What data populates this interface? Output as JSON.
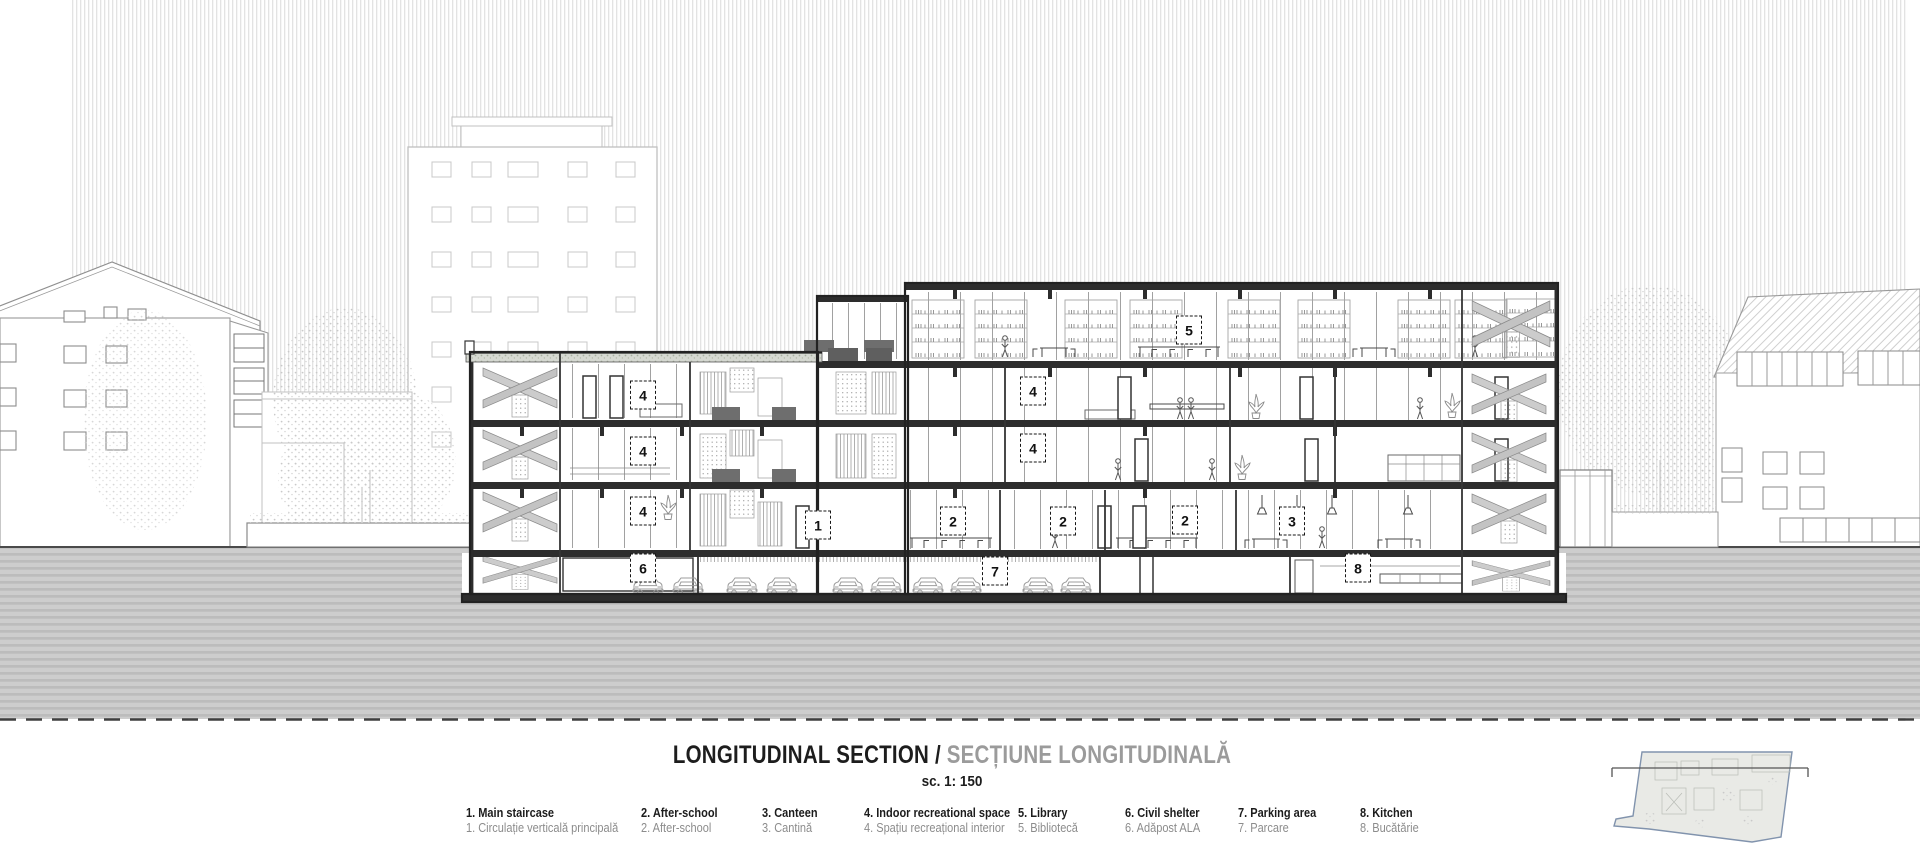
{
  "title": {
    "en": "LONGITUDINAL SECTION /",
    "ro": "SECȚIUNE LONGITUDINALĂ",
    "scale": "sc. 1: 150"
  },
  "legend_items": [
    {
      "en": "1. Main staircase",
      "ro": "1. Circulație verticală principală",
      "x": 466
    },
    {
      "en": "2. After-school",
      "ro": "2. After-school",
      "x": 641
    },
    {
      "en": "3. Canteen",
      "ro": "3. Cantină",
      "x": 762
    },
    {
      "en": "4. Indoor recreational space",
      "ro": "4. Spațiu recreațional interior",
      "x": 864
    },
    {
      "en": "5. Library",
      "ro": "5. Bibliotecă",
      "x": 1018
    },
    {
      "en": "6. Civil shelter",
      "ro": "6. Adăpost ALA",
      "x": 1125
    },
    {
      "en": "7. Parking area",
      "ro": "7. Parcare",
      "x": 1238
    },
    {
      "en": "8. Kitchen",
      "ro": "8. Bucătărie",
      "x": 1360
    }
  ],
  "section_labels": [
    {
      "n": "5",
      "x": 1189,
      "y": 330
    },
    {
      "n": "4",
      "x": 643,
      "y": 395
    },
    {
      "n": "4",
      "x": 1033,
      "y": 391
    },
    {
      "n": "4",
      "x": 643,
      "y": 451
    },
    {
      "n": "4",
      "x": 1033,
      "y": 448
    },
    {
      "n": "4",
      "x": 643,
      "y": 511
    },
    {
      "n": "1",
      "x": 818,
      "y": 525
    },
    {
      "n": "2",
      "x": 953,
      "y": 521
    },
    {
      "n": "2",
      "x": 1063,
      "y": 521
    },
    {
      "n": "2",
      "x": 1185,
      "y": 520
    },
    {
      "n": "3",
      "x": 1292,
      "y": 521
    },
    {
      "n": "6",
      "x": 643,
      "y": 568
    },
    {
      "n": "7",
      "x": 995,
      "y": 571
    },
    {
      "n": "8",
      "x": 1358,
      "y": 568
    }
  ],
  "colors": {
    "ink": "#1d1d1d",
    "muted": "#9b9b9b",
    "plan_outline": "#8193ad"
  }
}
